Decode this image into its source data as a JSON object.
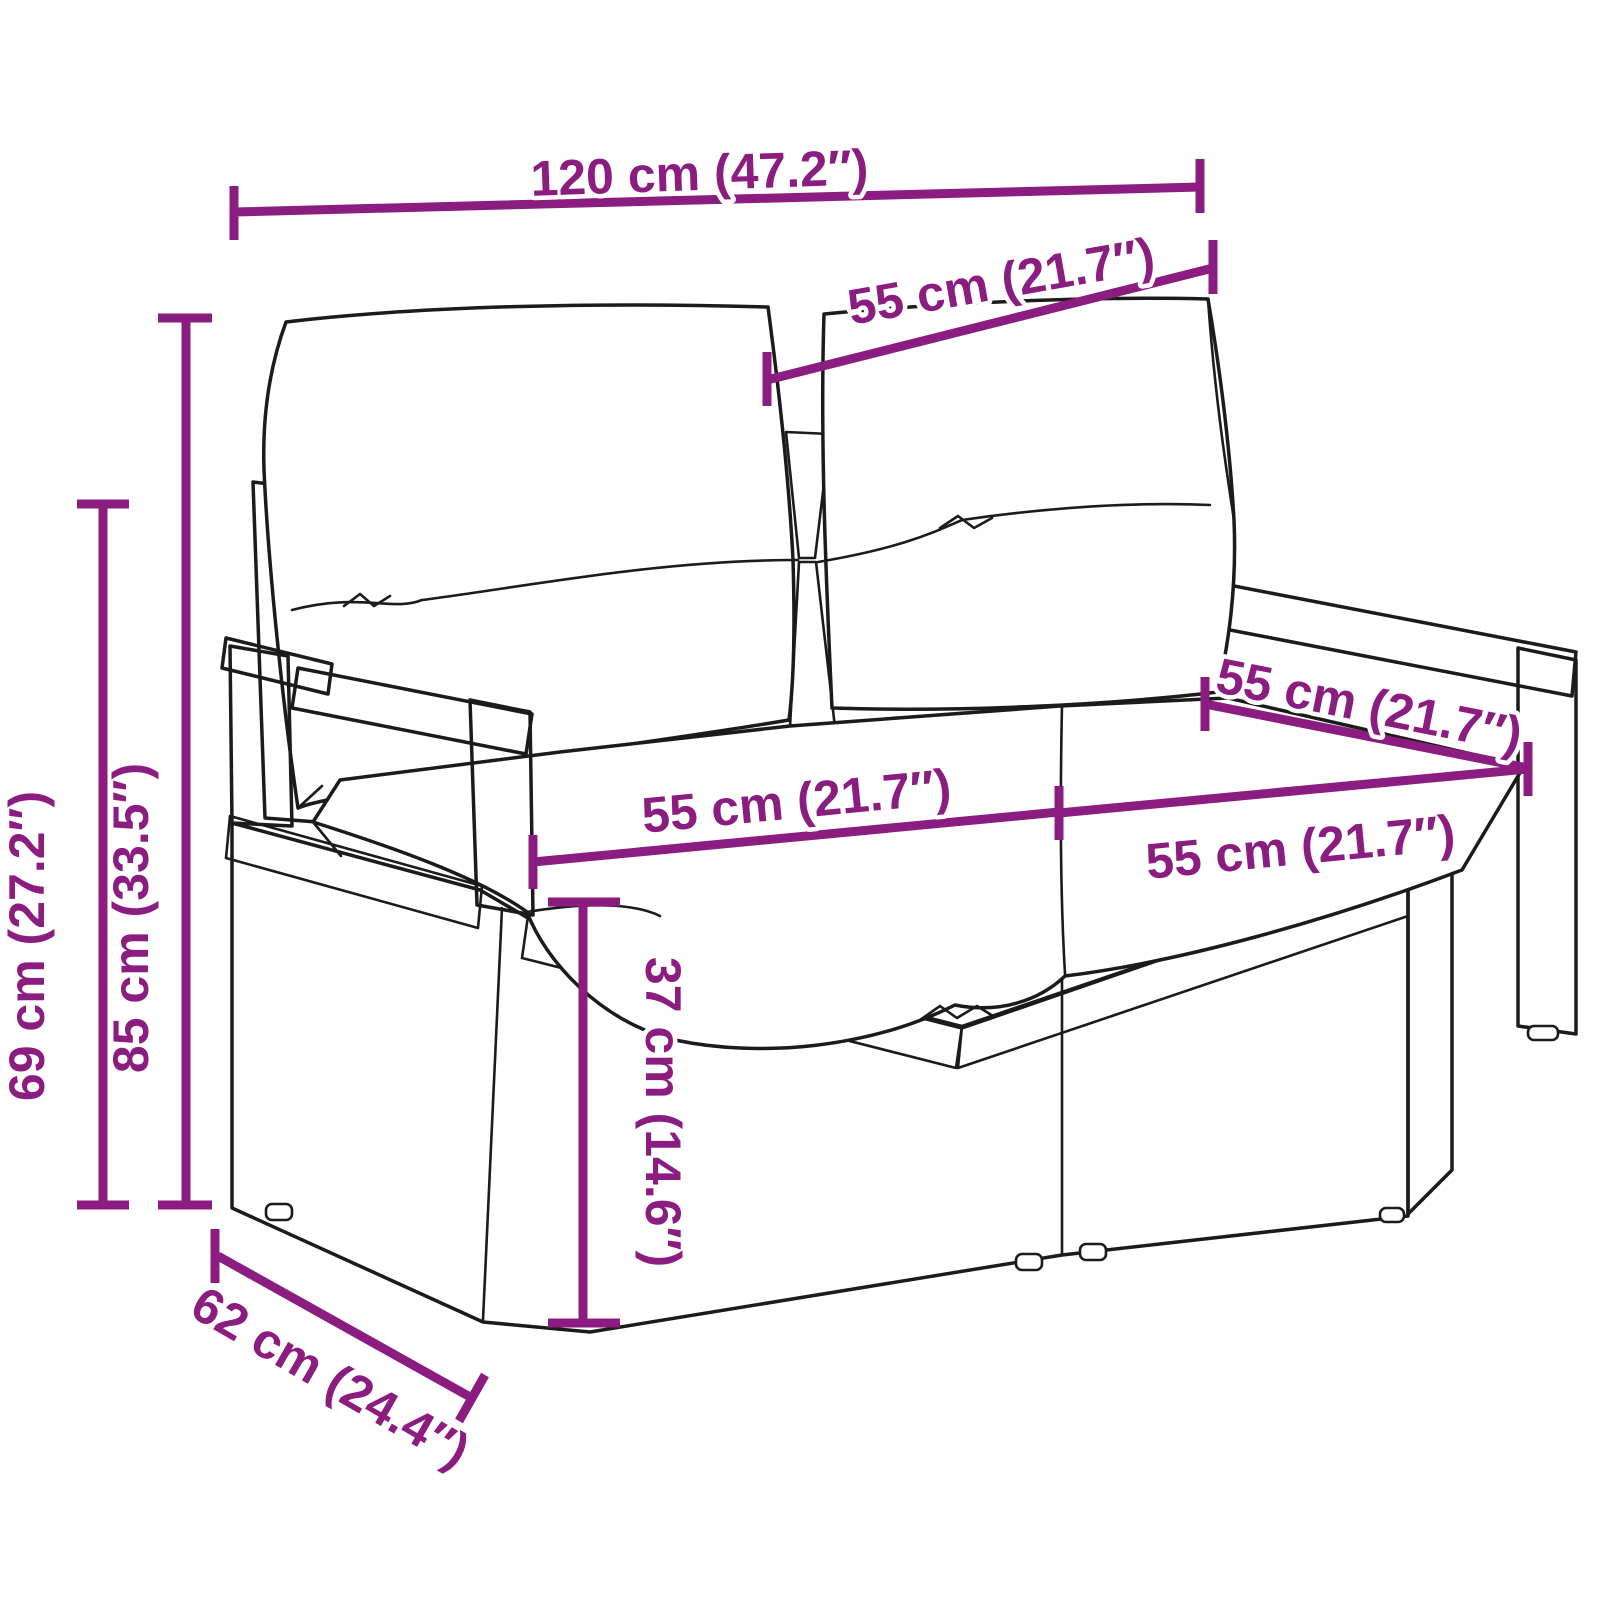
{
  "diagram": {
    "subject": "poly-rattan-two-seater-garden-bench-with-cushions-line-drawing",
    "colors": {
      "dimension": "#8C1D80",
      "line_art": "#1b1b1b",
      "background": "#ffffff",
      "cushion": "#ffffff"
    },
    "dimensions": {
      "total_width": "120 cm (47.2″)",
      "back_cushion_width": "55 cm (21.7″)",
      "total_height": "85 cm (33.5″)",
      "armrest_height": "69 cm (27.2″)",
      "seat_width_left": "55 cm (21.7″)",
      "seat_width_right": "55 cm (21.7″)",
      "seat_depth": "55 cm (21.7″)",
      "seat_height": "37 cm (14.6″)",
      "total_depth": "62 cm (24.4″)"
    }
  }
}
